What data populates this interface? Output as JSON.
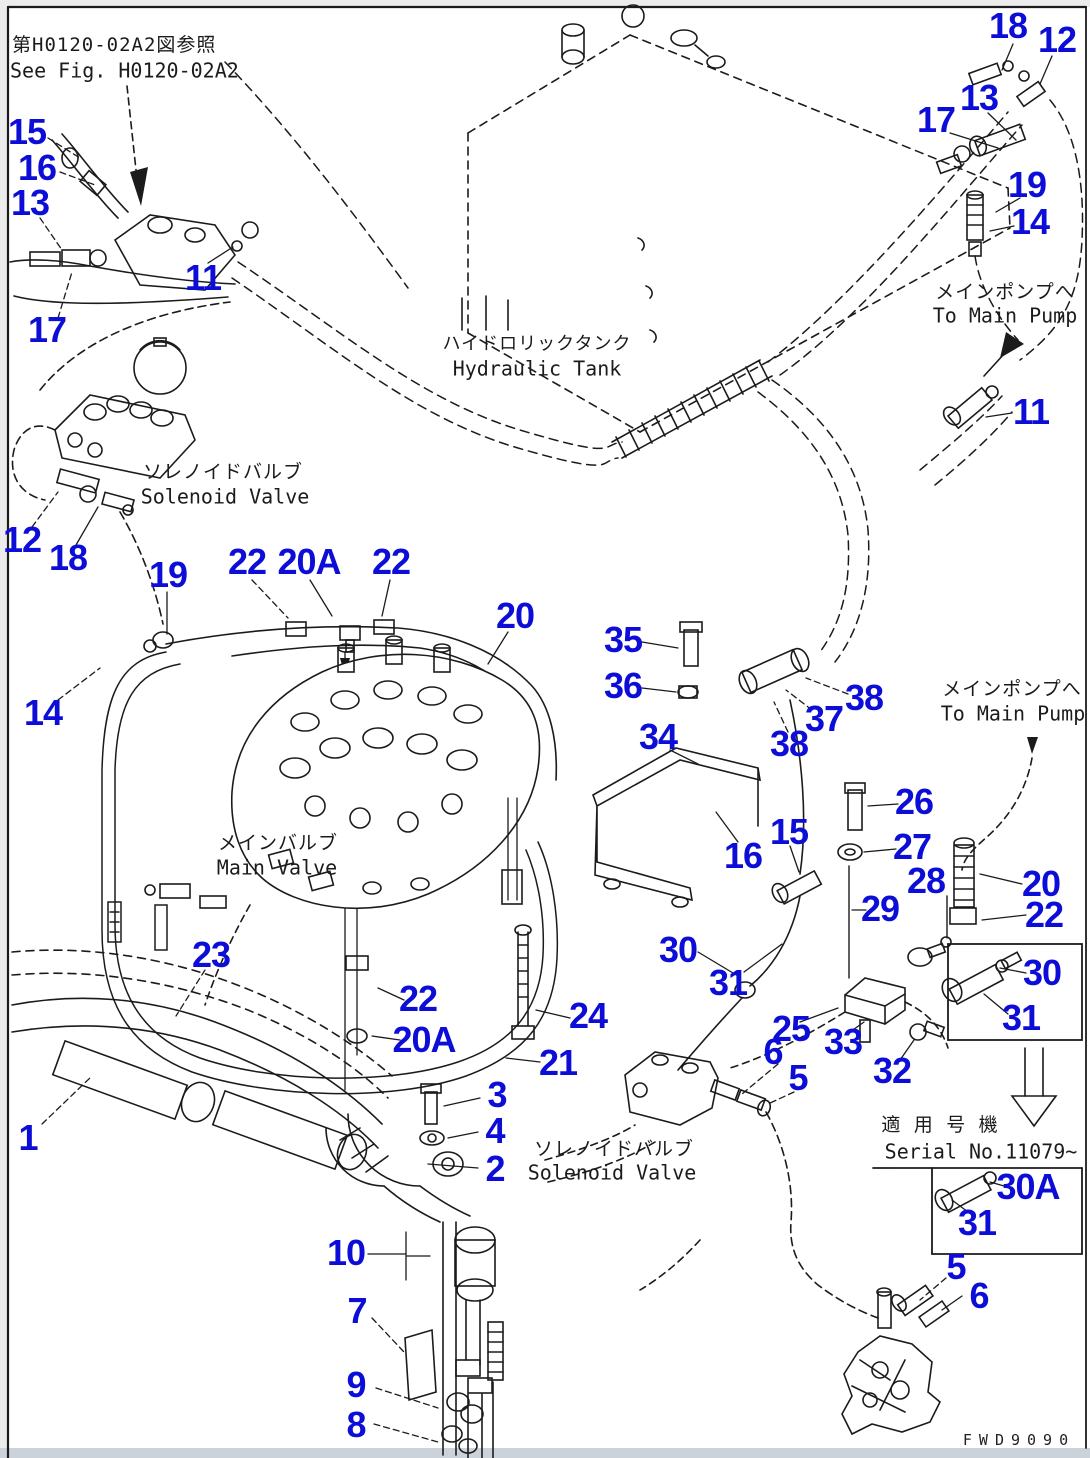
{
  "page": {
    "background": "#ffffff",
    "line_color": "#1b1b1b",
    "callout_color": "#0d0dd8",
    "drawing_code": "FWD9090"
  },
  "notes": {
    "see_fig_jp": "第H0120-02A2図参照",
    "see_fig_en": "See Fig. H0120-02A2",
    "serial_jp": "適 用 号 機",
    "serial_en": "Serial No.11079~"
  },
  "labels": {
    "hydraulic_tank_jp": "ハイドロリックタンク",
    "hydraulic_tank_en": "Hydraulic Tank",
    "to_main_pump_top_jp": "メインポンプへ",
    "to_main_pump_top_en": "To Main Pump",
    "to_main_pump_mid_jp": "メインポンプへ",
    "to_main_pump_mid_en": "To Main Pump",
    "solenoid_valve_left_jp": "ソレノイドバルブ",
    "solenoid_valve_left_en": "Solenoid Valve",
    "main_valve_jp": "メインバルブ",
    "main_valve_en": "Main Valve",
    "solenoid_valve_bottom_jp": "ソレノイドバルブ",
    "solenoid_valve_bottom_en": "Solenoid Valve"
  },
  "callouts": [
    {
      "n": "18",
      "x": 1008,
      "y": 26
    },
    {
      "n": "12",
      "x": 1057,
      "y": 40
    },
    {
      "n": "13",
      "x": 979,
      "y": 98
    },
    {
      "n": "17",
      "x": 936,
      "y": 120
    },
    {
      "n": "19",
      "x": 1027,
      "y": 185
    },
    {
      "n": "14",
      "x": 1030,
      "y": 222
    },
    {
      "n": "15",
      "x": 27,
      "y": 132
    },
    {
      "n": "16",
      "x": 37,
      "y": 168
    },
    {
      "n": "13",
      "x": 30,
      "y": 203
    },
    {
      "n": "11",
      "x": 203,
      "y": 278
    },
    {
      "n": "17",
      "x": 47,
      "y": 330
    },
    {
      "n": "11",
      "x": 1031,
      "y": 412
    },
    {
      "n": "12",
      "x": 22,
      "y": 540
    },
    {
      "n": "18",
      "x": 68,
      "y": 558
    },
    {
      "n": "19",
      "x": 168,
      "y": 575
    },
    {
      "n": "22",
      "x": 247,
      "y": 562
    },
    {
      "n": "20A",
      "x": 309,
      "y": 562
    },
    {
      "n": "22",
      "x": 391,
      "y": 562
    },
    {
      "n": "20",
      "x": 515,
      "y": 616
    },
    {
      "n": "14",
      "x": 43,
      "y": 713
    },
    {
      "n": "35",
      "x": 623,
      "y": 640
    },
    {
      "n": "36",
      "x": 623,
      "y": 686
    },
    {
      "n": "34",
      "x": 658,
      "y": 737
    },
    {
      "n": "38",
      "x": 789,
      "y": 744
    },
    {
      "n": "37",
      "x": 824,
      "y": 719
    },
    {
      "n": "38",
      "x": 864,
      "y": 698
    },
    {
      "n": "16",
      "x": 743,
      "y": 856
    },
    {
      "n": "15",
      "x": 789,
      "y": 832
    },
    {
      "n": "26",
      "x": 914,
      "y": 802
    },
    {
      "n": "27",
      "x": 912,
      "y": 847
    },
    {
      "n": "28",
      "x": 926,
      "y": 881
    },
    {
      "n": "29",
      "x": 880,
      "y": 909
    },
    {
      "n": "20",
      "x": 1041,
      "y": 884
    },
    {
      "n": "22",
      "x": 1044,
      "y": 915
    },
    {
      "n": "30",
      "x": 1042,
      "y": 973
    },
    {
      "n": "31",
      "x": 1021,
      "y": 1018
    },
    {
      "n": "30",
      "x": 678,
      "y": 950
    },
    {
      "n": "31",
      "x": 728,
      "y": 983
    },
    {
      "n": "25",
      "x": 791,
      "y": 1029
    },
    {
      "n": "33",
      "x": 843,
      "y": 1042
    },
    {
      "n": "32",
      "x": 892,
      "y": 1071
    },
    {
      "n": "6",
      "x": 773,
      "y": 1052
    },
    {
      "n": "5",
      "x": 798,
      "y": 1078
    },
    {
      "n": "23",
      "x": 211,
      "y": 955
    },
    {
      "n": "22",
      "x": 418,
      "y": 999
    },
    {
      "n": "20A",
      "x": 424,
      "y": 1040
    },
    {
      "n": "24",
      "x": 588,
      "y": 1016
    },
    {
      "n": "21",
      "x": 558,
      "y": 1063
    },
    {
      "n": "1",
      "x": 28,
      "y": 1138
    },
    {
      "n": "3",
      "x": 497,
      "y": 1095
    },
    {
      "n": "4",
      "x": 495,
      "y": 1131
    },
    {
      "n": "2",
      "x": 495,
      "y": 1169
    },
    {
      "n": "10",
      "x": 346,
      "y": 1253
    },
    {
      "n": "7",
      "x": 357,
      "y": 1311
    },
    {
      "n": "9",
      "x": 356,
      "y": 1385
    },
    {
      "n": "8",
      "x": 356,
      "y": 1425
    },
    {
      "n": "30A",
      "x": 1028,
      "y": 1187
    },
    {
      "n": "31",
      "x": 977,
      "y": 1223
    },
    {
      "n": "5",
      "x": 956,
      "y": 1267
    },
    {
      "n": "6",
      "x": 979,
      "y": 1296
    }
  ]
}
